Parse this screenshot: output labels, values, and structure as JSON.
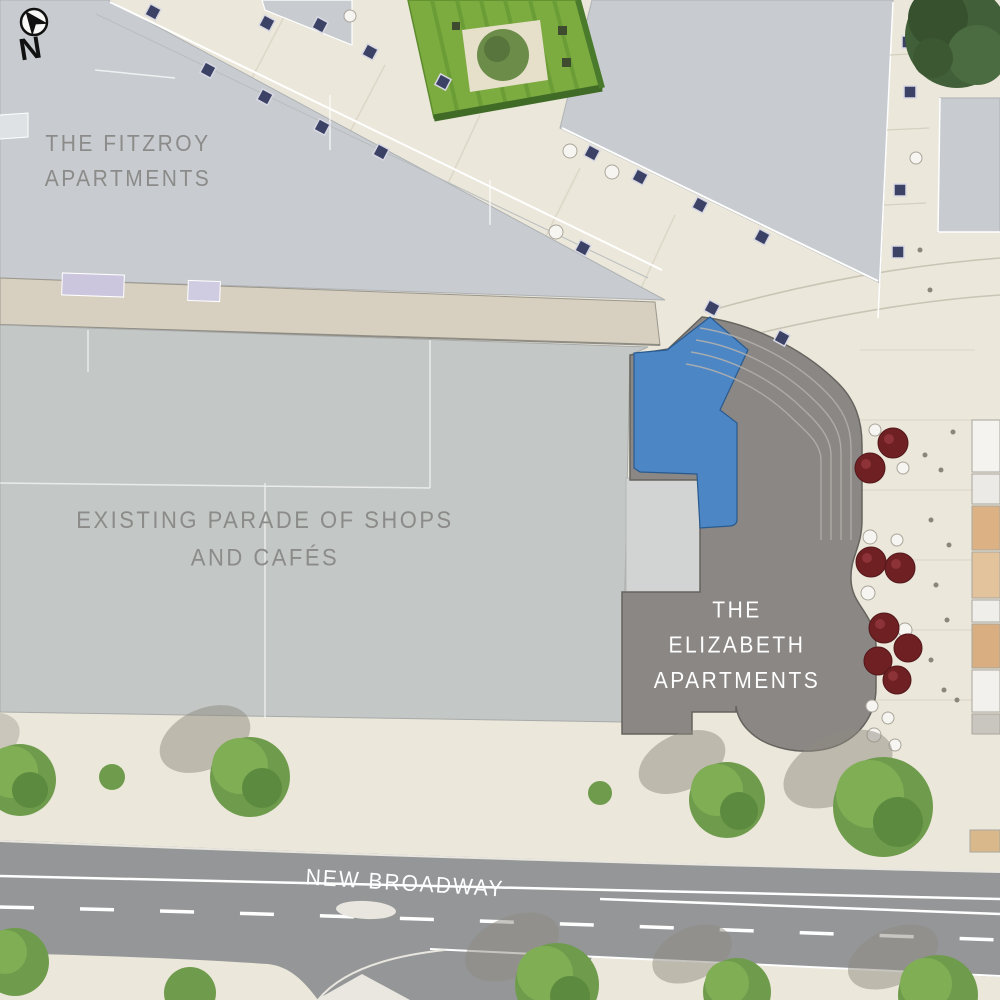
{
  "title": "Site plan — New Broadway masterplan",
  "compass": {
    "letter": "N"
  },
  "labels": {
    "fitzroy": {
      "lines": [
        "THE FITZROY",
        "APARTMENTS"
      ]
    },
    "parade": {
      "lines": [
        "EXISTING PARADE OF SHOPS",
        "AND CAFÉS"
      ]
    },
    "elizabeth": {
      "lines": [
        "THE",
        "ELIZABETH",
        "APARTMENTS"
      ]
    },
    "road": {
      "name": "NEW BROADWAY"
    }
  },
  "colors": {
    "highlight_blue": "#4c86c5",
    "elizabeth_gray": "#8a8784",
    "building_light_blue": "#c8ccd0",
    "building_light_gray": "#c3c7c6",
    "paving_cream": "#ebe7da",
    "road_gray": "#949697",
    "tree_green": "#6f9c4c",
    "dark_tree_green": "#415f38",
    "umbrella_red": "#6e2023",
    "bench_navy": "#3c4265",
    "canopy_tan": "#d7d0c1",
    "label_gray": "#8b8b89",
    "label_white": "#ffffff"
  }
}
